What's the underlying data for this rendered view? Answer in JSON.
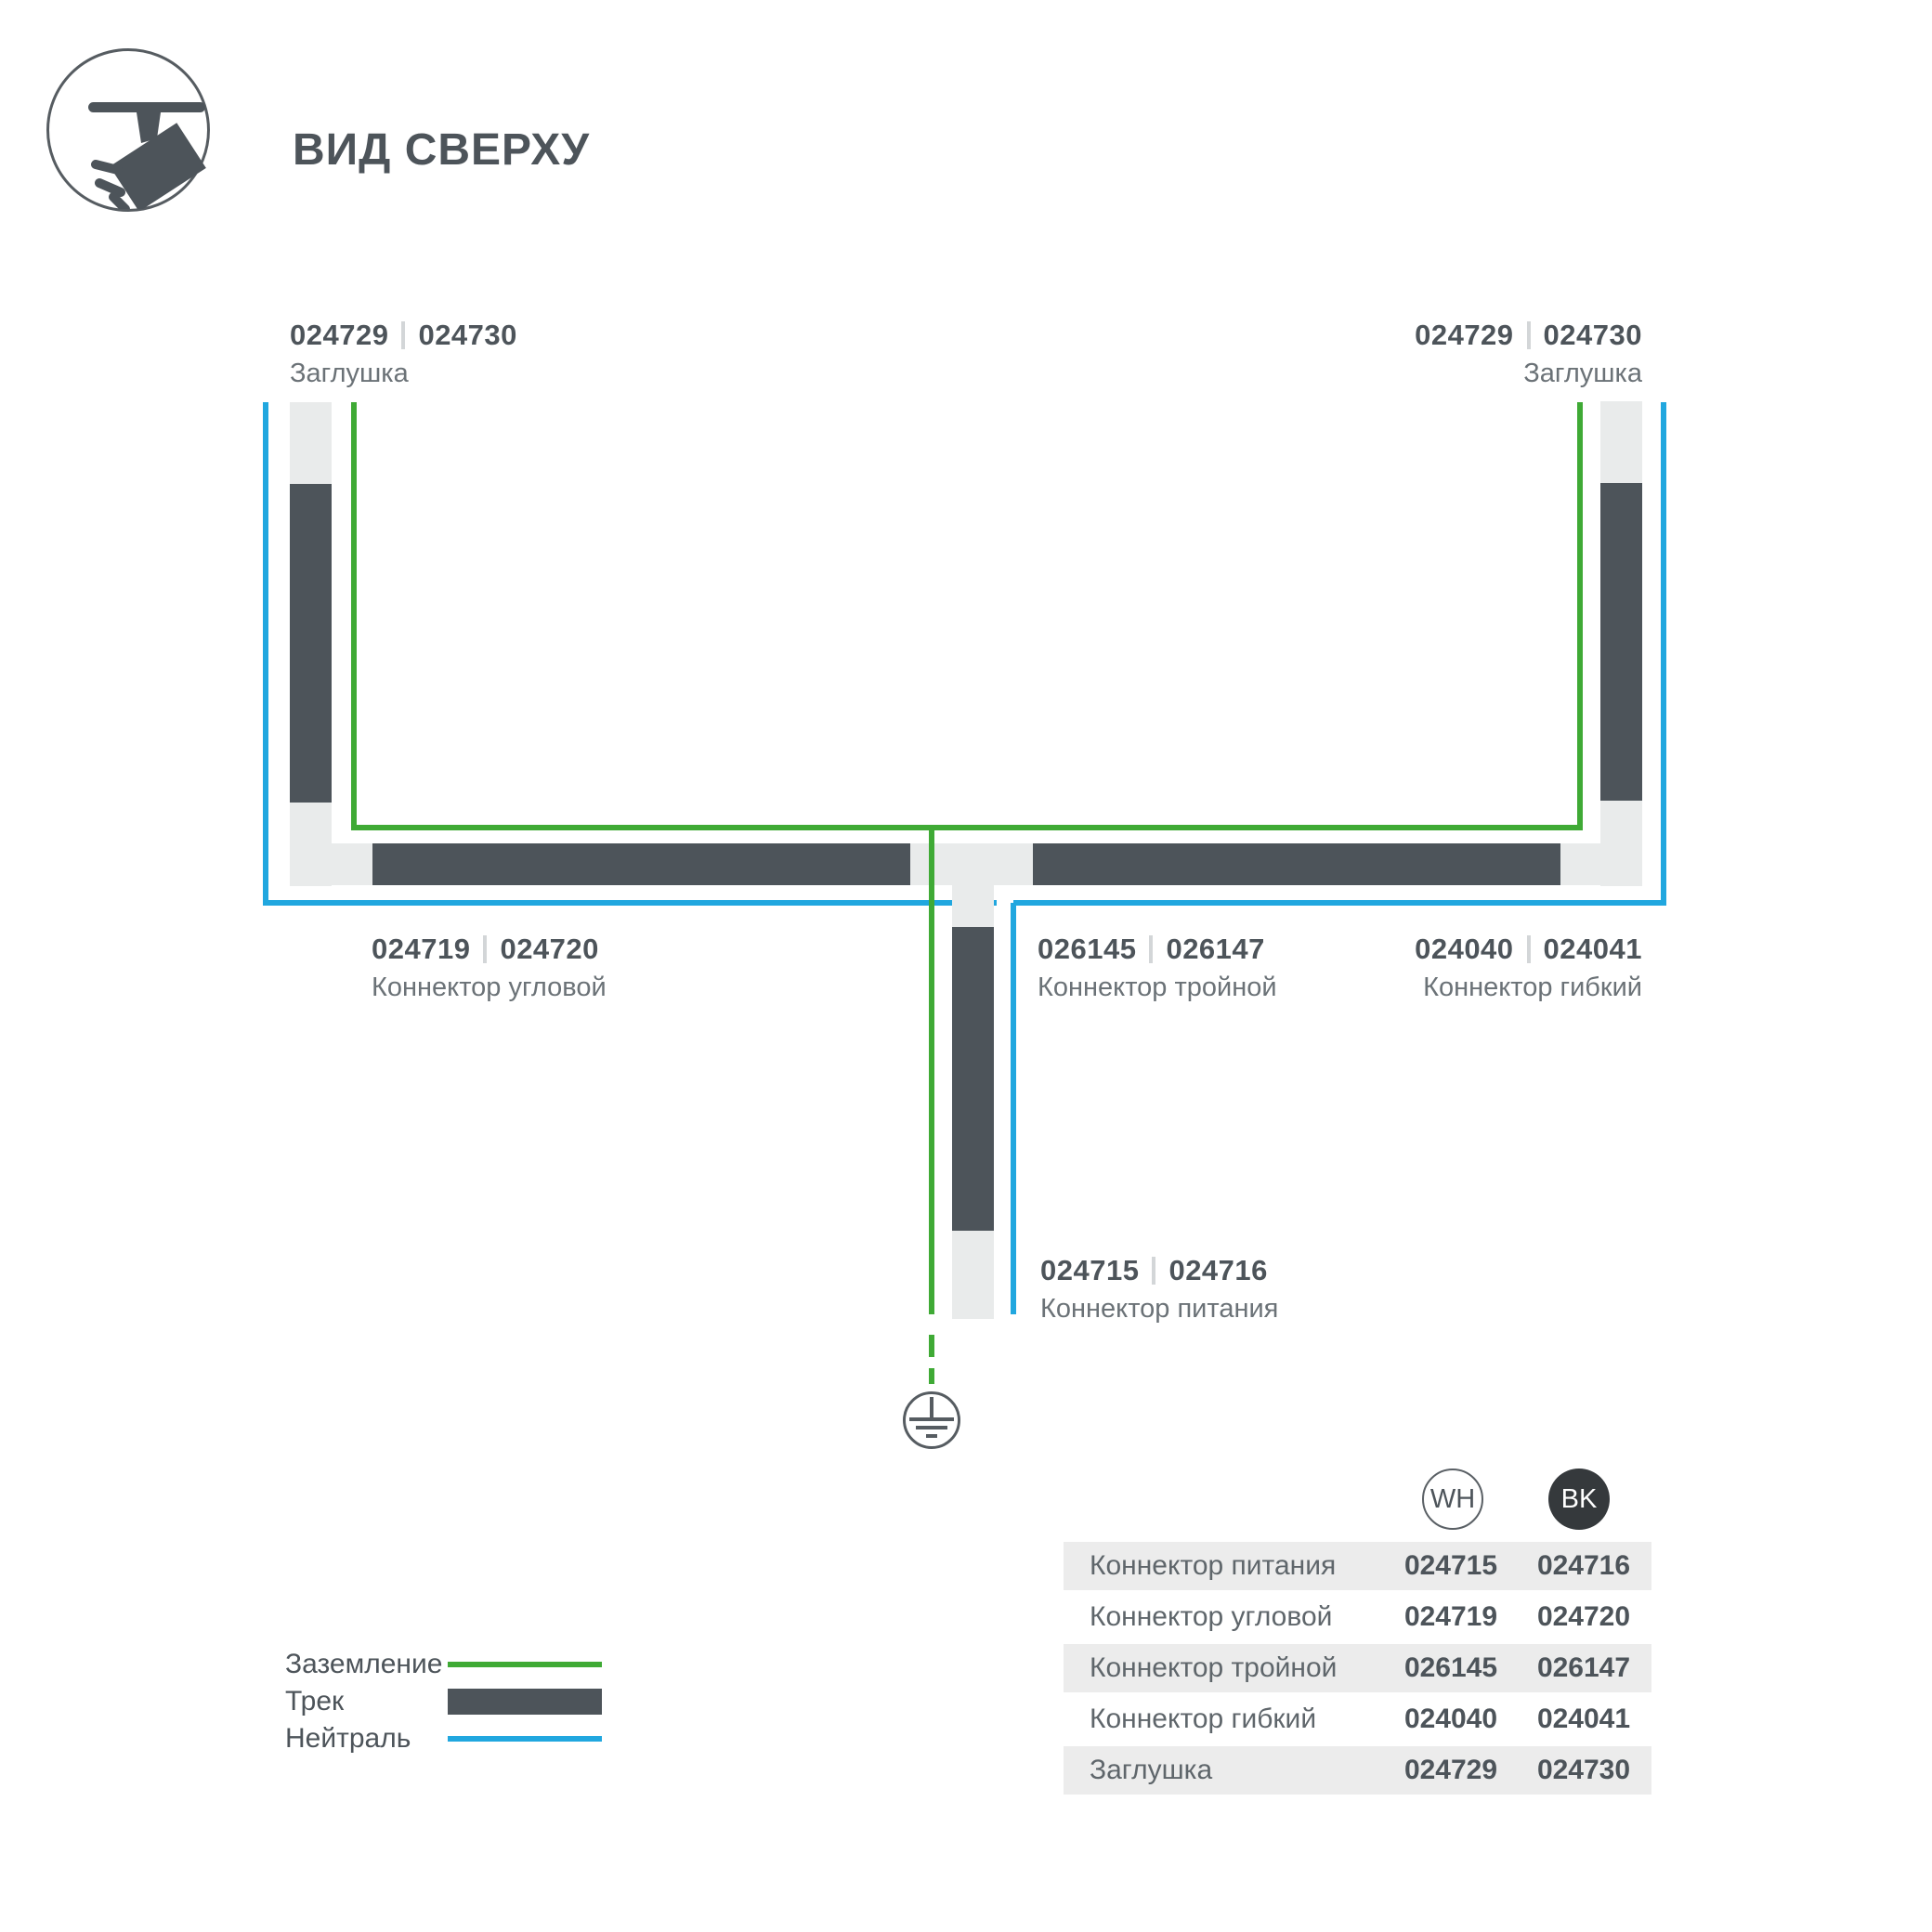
{
  "header": {
    "title": "ВИД СВЕРХУ"
  },
  "diagram": {
    "labels": {
      "cap_left": {
        "code_wh": "024729",
        "code_bk": "024730",
        "name": "Заглушка"
      },
      "cap_right": {
        "code_wh": "024729",
        "code_bk": "024730",
        "name": "Заглушка"
      },
      "corner": {
        "code_wh": "024719",
        "code_bk": "024720",
        "name": "Коннектор угловой"
      },
      "triple": {
        "code_wh": "026145",
        "code_bk": "026147",
        "name": "Коннектор тройной"
      },
      "flex": {
        "code_wh": "024040",
        "code_bk": "024041",
        "name": "Коннектор гибкий"
      },
      "power": {
        "code_wh": "024715",
        "code_bk": "024716",
        "name": "Коннектор питания"
      }
    },
    "colors": {
      "ground_green": "#3faa35",
      "neutral_blue": "#21a7df",
      "track_dark": "#4d545a",
      "connector_light": "#e9ebeb"
    }
  },
  "legend": {
    "items": [
      {
        "label": "Заземление",
        "type": "ground"
      },
      {
        "label": "Трек",
        "type": "track"
      },
      {
        "label": "Нейтраль",
        "type": "neutral"
      }
    ]
  },
  "table": {
    "columns": [
      {
        "label": "WH"
      },
      {
        "label": "BK"
      }
    ],
    "rows": [
      {
        "name": "Коннектор питания",
        "wh": "024715",
        "bk": "024716"
      },
      {
        "name": "Коннектор угловой",
        "wh": "024719",
        "bk": "024720"
      },
      {
        "name": "Коннектор тройной",
        "wh": "026145",
        "bk": "026147"
      },
      {
        "name": "Коннектор гибкий",
        "wh": "024040",
        "bk": "024041"
      },
      {
        "name": "Заглушка",
        "wh": "024729",
        "bk": "024730"
      }
    ]
  }
}
